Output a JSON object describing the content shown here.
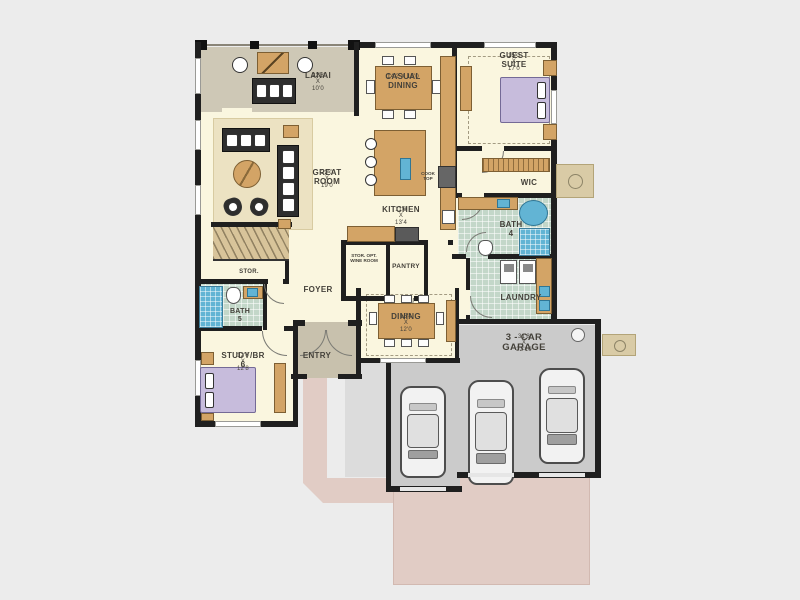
{
  "plan": {
    "rooms": {
      "lanai": {
        "name": "LANAI",
        "dims": "22'8 X 10'0"
      },
      "great_room": {
        "name": "GREAT ROOM",
        "dims": "22'0 X 19'0"
      },
      "casual_dining": {
        "name": "CASUAL DINING",
        "dims": "14'2 X 15'0"
      },
      "kitchen": {
        "name": "KITCHEN",
        "dims": "11'0 X 13'4"
      },
      "guest_suite": {
        "name": "GUEST SUITE",
        "dims": "15'0 X 17'0"
      },
      "wic": {
        "name": "WIC"
      },
      "bath4": {
        "name": "BATH 4"
      },
      "laundry": {
        "name": "LAUNDRY"
      },
      "pantry": {
        "name": "PANTRY"
      },
      "wine": {
        "name": "STOR. OPT. WINE ROOM"
      },
      "foyer": {
        "name": "FOYER"
      },
      "stor": {
        "name": "STOR."
      },
      "bath5": {
        "name": "BATH 5"
      },
      "study": {
        "name": "STUDY/BR 6",
        "dims": "12'0 X 12'8"
      },
      "entry": {
        "name": "ENTRY"
      },
      "dining": {
        "name": "DINING",
        "dims": "16'4 X 12'0"
      },
      "garage": {
        "name": "3 - CAR GARAGE",
        "dims": "31'8 X 22'10"
      },
      "cooktop": {
        "name": "COOK TOP"
      }
    },
    "colors": {
      "background": "#ececec",
      "wall": "#1f1f1f",
      "floor": "#faf6df",
      "lanai_floor": "#cec8b6",
      "entry_floor": "#c8c1ad",
      "garage_floor": "#cbcbcb",
      "driveway": "#e1ccc5",
      "tile": "#c3d7c9",
      "water": "#62b4d4",
      "wood": "#d3a466",
      "bed": "#c7bcdc"
    }
  }
}
